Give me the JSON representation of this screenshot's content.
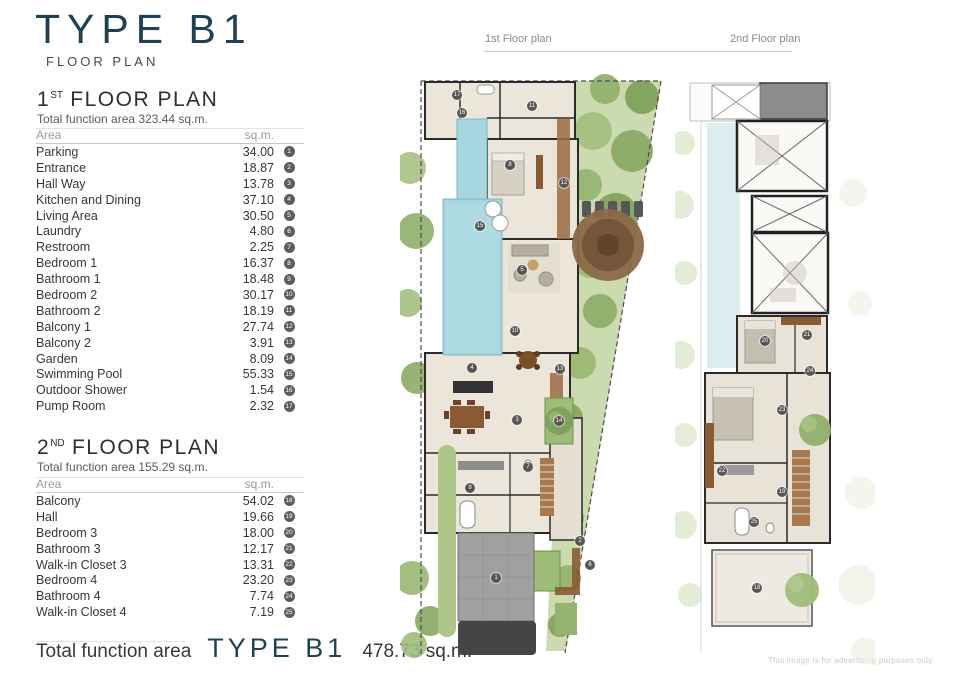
{
  "page": {
    "title": "TYPE B1",
    "subtitle": "FLOOR PLAN",
    "accent_color": "#1e4254",
    "disclaimer": "This image is for advertising purposes only."
  },
  "plan_labels": {
    "first": "1st Floor plan",
    "second": "2nd Floor plan"
  },
  "first_floor": {
    "heading_prefix": "1",
    "heading_sup": "ST",
    "heading_rest": " FLOOR PLAN",
    "total": "Total function area 323.44 sq.m.",
    "table": {
      "col_area": "Area",
      "col_sqm": "sq.m.",
      "rows": [
        {
          "name": "Parking",
          "value": "34.00",
          "num": "1"
        },
        {
          "name": "Entrance",
          "value": "18.87",
          "num": "2"
        },
        {
          "name": "Hall Way",
          "value": "13.78",
          "num": "3"
        },
        {
          "name": "Kitchen and Dining",
          "value": "37.10",
          "num": "4"
        },
        {
          "name": "Living Area",
          "value": "30.50",
          "num": "5"
        },
        {
          "name": "Laundry",
          "value": "4.80",
          "num": "6"
        },
        {
          "name": "Restroom",
          "value": "2.25",
          "num": "7"
        },
        {
          "name": "Bedroom 1",
          "value": "16.37",
          "num": "8"
        },
        {
          "name": "Bathroom 1",
          "value": "18.48",
          "num": "9"
        },
        {
          "name": "Bedroom 2",
          "value": "30.17",
          "num": "10"
        },
        {
          "name": "Bathroom 2",
          "value": "18.19",
          "num": "11"
        },
        {
          "name": "Balcony 1",
          "value": "27.74",
          "num": "12"
        },
        {
          "name": "Balcony 2",
          "value": "3.91",
          "num": "13"
        },
        {
          "name": "Garden",
          "value": "8.09",
          "num": "14"
        },
        {
          "name": "Swimming Pool",
          "value": "55.33",
          "num": "15"
        },
        {
          "name": "Outdoor Shower",
          "value": "1.54",
          "num": "16"
        },
        {
          "name": "Pump Room",
          "value": "2.32",
          "num": "17"
        }
      ]
    }
  },
  "second_floor": {
    "heading_prefix": "2",
    "heading_sup": "ND",
    "heading_rest": " FLOOR PLAN",
    "total": "Total function area 155.29 sq.m.",
    "table": {
      "col_area": "Area",
      "col_sqm": "sq.m.",
      "rows": [
        {
          "name": "Balcony",
          "value": "54.02",
          "num": "18"
        },
        {
          "name": "Hall",
          "value": "19.66",
          "num": "19"
        },
        {
          "name": "Bedroom 3",
          "value": "18.00",
          "num": "20"
        },
        {
          "name": "Bathroom 3",
          "value": "12.17",
          "num": "21"
        },
        {
          "name": "Walk-in Closet 3",
          "value": "13.31",
          "num": "22"
        },
        {
          "name": "Bedroom 4",
          "value": "23.20",
          "num": "23"
        },
        {
          "name": "Bathroom 4",
          "value": "7.74",
          "num": "24"
        },
        {
          "name": "Walk-in Closet 4",
          "value": "7.19",
          "num": "25"
        }
      ]
    }
  },
  "footer": {
    "label": "Total function area",
    "type": "TYPE B1",
    "value": "478.73 sq.m."
  },
  "plan1_badges": [
    {
      "n": "17",
      "x": 57,
      "y": 22
    },
    {
      "n": "16",
      "x": 62,
      "y": 40
    },
    {
      "n": "11",
      "x": 132,
      "y": 33
    },
    {
      "n": "8",
      "x": 110,
      "y": 92
    },
    {
      "n": "12",
      "x": 164,
      "y": 110
    },
    {
      "n": "15",
      "x": 80,
      "y": 153
    },
    {
      "n": "5",
      "x": 122,
      "y": 197
    },
    {
      "n": "10",
      "x": 115,
      "y": 258
    },
    {
      "n": "13",
      "x": 160,
      "y": 296
    },
    {
      "n": "4",
      "x": 72,
      "y": 295
    },
    {
      "n": "3",
      "x": 117,
      "y": 347
    },
    {
      "n": "14",
      "x": 159,
      "y": 348
    },
    {
      "n": "7",
      "x": 128,
      "y": 394
    },
    {
      "n": "9",
      "x": 70,
      "y": 415
    },
    {
      "n": "2",
      "x": 180,
      "y": 468
    },
    {
      "n": "6",
      "x": 190,
      "y": 492
    },
    {
      "n": "1",
      "x": 96,
      "y": 505
    }
  ],
  "plan2_badges": [
    {
      "n": "20",
      "x": 90,
      "y": 268
    },
    {
      "n": "21",
      "x": 132,
      "y": 262
    },
    {
      "n": "24",
      "x": 135,
      "y": 298
    },
    {
      "n": "23",
      "x": 107,
      "y": 337
    },
    {
      "n": "22",
      "x": 47,
      "y": 398
    },
    {
      "n": "19",
      "x": 107,
      "y": 419
    },
    {
      "n": "25",
      "x": 79,
      "y": 449
    },
    {
      "n": "18",
      "x": 82,
      "y": 515
    }
  ]
}
